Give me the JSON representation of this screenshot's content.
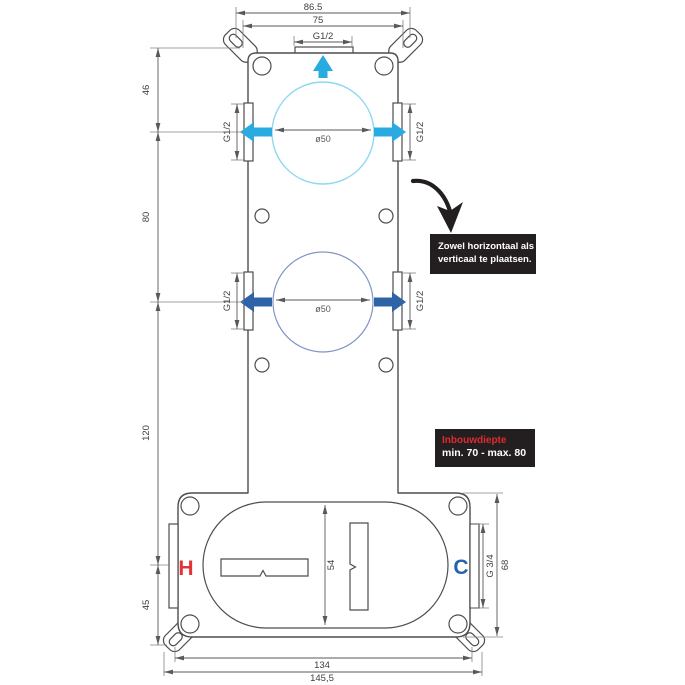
{
  "diagram": {
    "type": "technical-installation-drawing",
    "dims": {
      "top_outer": "86.5",
      "top_inner": "75",
      "top_thread": "G1/2",
      "left_seg_46": "46",
      "left_seg_80": "80",
      "left_seg_120": "120",
      "left_seg_45": "45",
      "top_circle_dia": "ø50",
      "bottom_circle_dia": "ø50",
      "side_thread": "G1/2",
      "box_inner_height": "54",
      "box_side_thread": "G 3/4",
      "box_height": "68",
      "bottom_inner": "134",
      "bottom_outer": "145,5"
    },
    "ports": {
      "hot": "H",
      "cold": "C"
    },
    "notes": {
      "placement_line1": "Zowel horizontaal als",
      "placement_line2": "verticaal te plaatsen.",
      "depth_label": "Inbouwdiepte",
      "depth_range": "min. 70 - max. 80"
    },
    "colors": {
      "line": "#4d4d4f",
      "dim_line": "#58595b",
      "cyan_arrow": "#29abe2",
      "cyan_circle": "#8fd8f2",
      "blue_arrow": "#2f63a8",
      "blue_circle": "#8094c6",
      "hot_red": "#e23438",
      "cold_blue": "#2563af",
      "note_bg": "#231f20",
      "depth_red": "#e02b2f"
    }
  }
}
